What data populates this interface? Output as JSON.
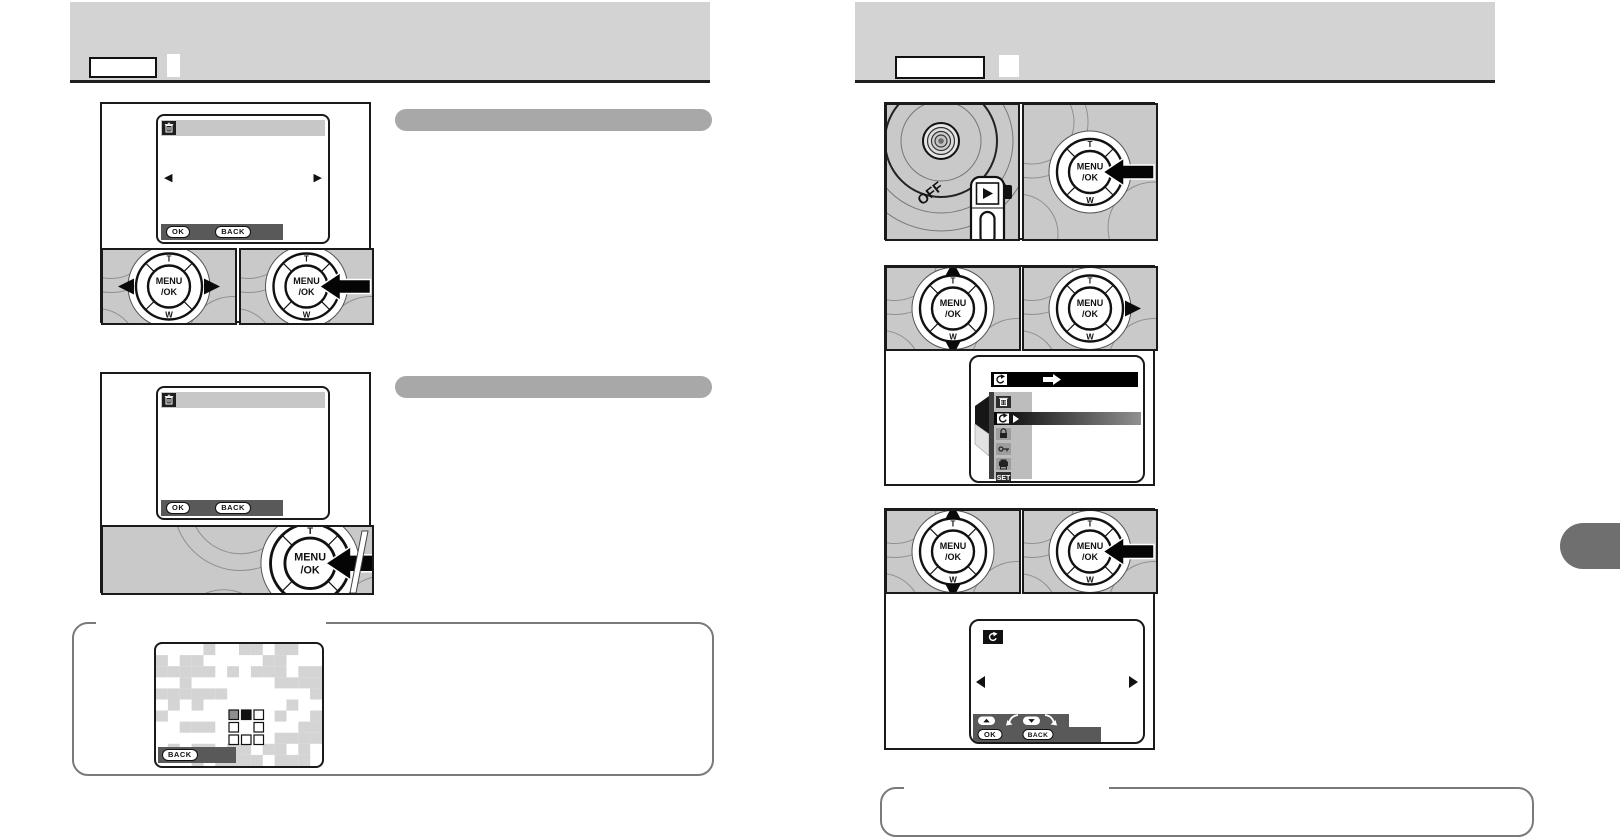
{
  "header_left": {
    "label_box": "",
    "corner_square": ""
  },
  "header_right": {
    "label_box": "",
    "corner_square": ""
  },
  "section_bar_1": "",
  "section_bar_2": "",
  "dpad": {
    "top_label": "T",
    "bottom_label": "W",
    "center_label_line1": "MENU",
    "center_label_line2": "/OK"
  },
  "mode_dial": {
    "off_label": "OFF",
    "icons": [
      "playback-icon",
      "camera-icon"
    ]
  },
  "buttons": {
    "ok": "OK",
    "back": "BACK"
  },
  "menu": {
    "set_label": "SET",
    "items": [
      "erase",
      "image-rotate",
      "protect",
      "key-protect",
      "print",
      "set-up"
    ],
    "selected_item": "image-rotate"
  },
  "rotate_screen": {
    "up_hint_icon": "rotate-ccw-icon",
    "down_hint_icon": "rotate-cw-icon"
  },
  "colors": {
    "header_gray": "#d3d3d3",
    "panel_gray": "#c9c9c9",
    "section_bar_gray": "#a8a8a8",
    "dark_bar": "#595959",
    "checker_gray": "#d4d4d4",
    "tab_gray": "#6f6f6f",
    "ink": "#111111"
  }
}
